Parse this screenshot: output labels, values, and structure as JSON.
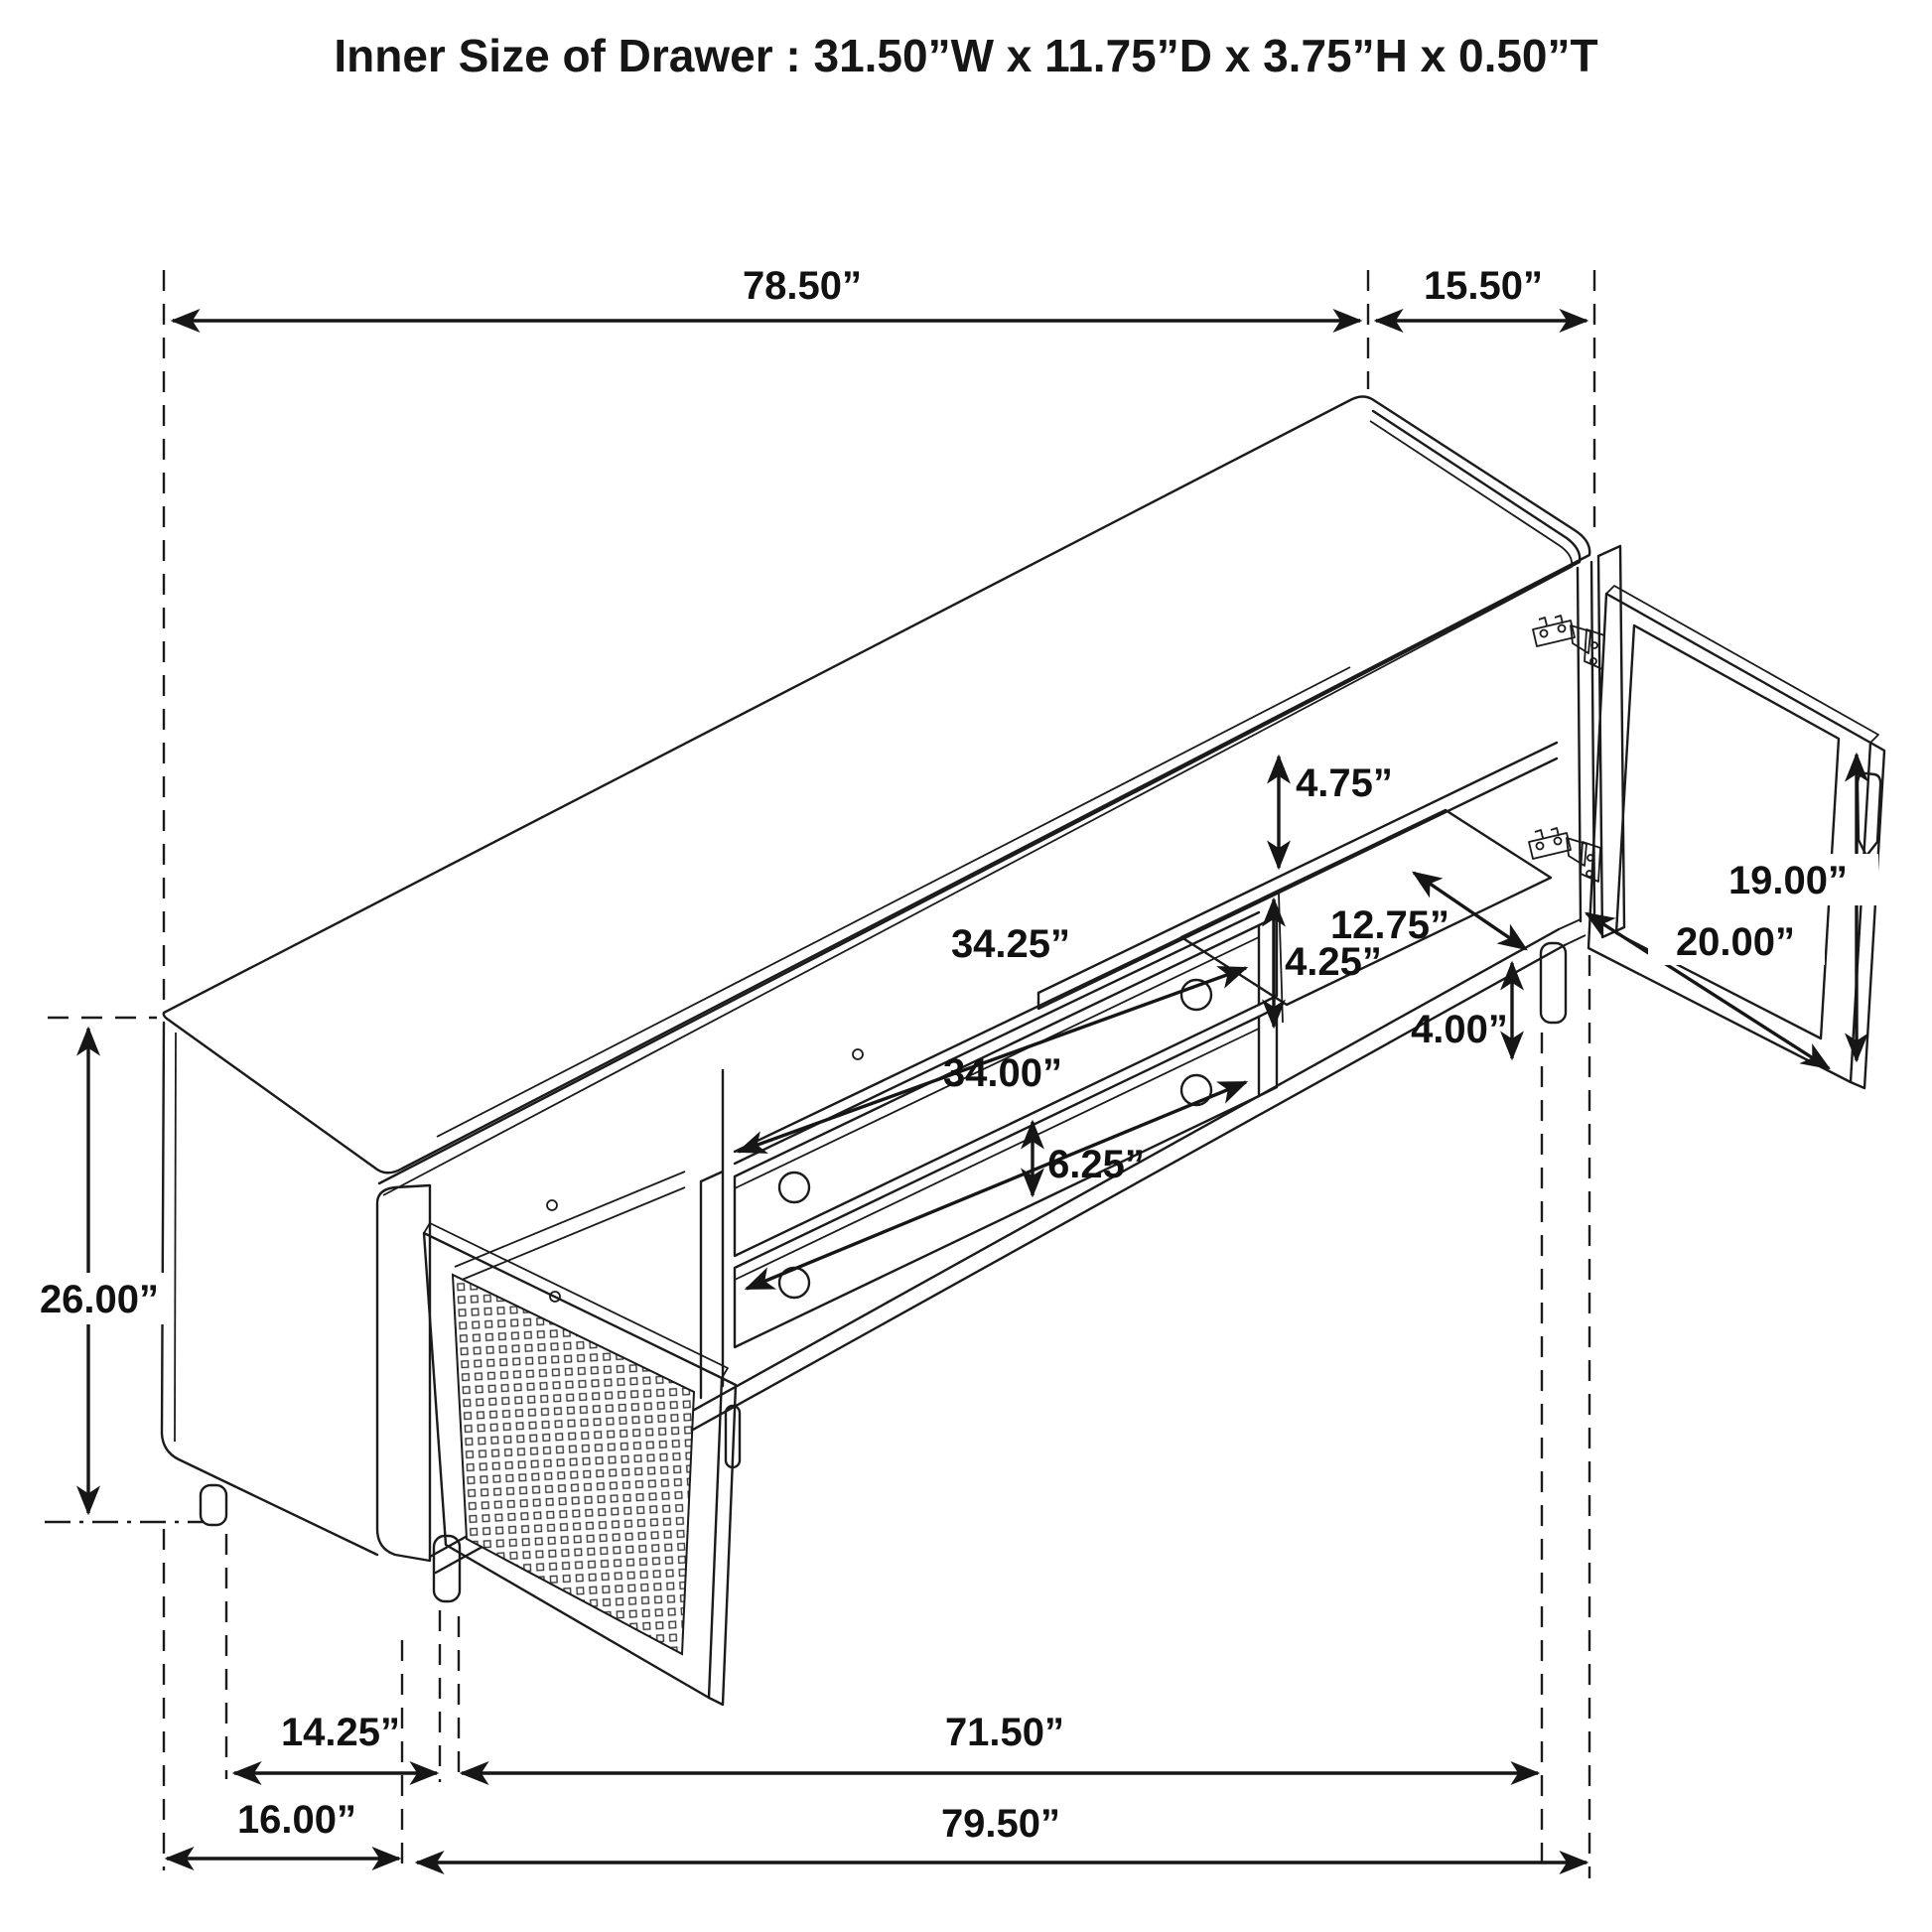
{
  "title": "Inner Size of Drawer : 31.50”W x 11.75”D x 3.75”H x 0.50”T",
  "drawer_inner_size": {
    "width_in": 31.5,
    "depth_in": 11.75,
    "height_in": 3.75,
    "thickness_in": 0.5
  },
  "units": "inches",
  "diagram_type": "furniture-dimension-line-drawing",
  "subject": "TV console sideboard, isometric view with open cane door, open right door and two drawers",
  "colors": {
    "background": "#ffffff",
    "line": "#1b1b1b",
    "label": "#111111"
  },
  "icons": [
    "dimension-arrow-icon",
    "hinge-icon",
    "knob-icon",
    "door-handle-icon",
    "cane-mesh-pattern"
  ],
  "dims": {
    "top_width": {
      "label": "78.50”",
      "value": 78.5,
      "meaning": "top panel length"
    },
    "top_depth": {
      "label": "15.50”",
      "value": 15.5,
      "meaning": "top panel depth"
    },
    "height": {
      "label": "26.00”",
      "value": 26.0,
      "meaning": "overall height"
    },
    "shelf_clearance": {
      "label": "4.75”",
      "value": 4.75,
      "meaning": "upper shelf clearance"
    },
    "shelf_depth": {
      "label": "12.75”",
      "value": 12.75,
      "meaning": "interior shelf depth"
    },
    "door_height": {
      "label": "19.00”",
      "value": 19.0,
      "meaning": "right door height"
    },
    "door_width": {
      "label": "20.00”",
      "value": 20.0,
      "meaning": "right door width"
    },
    "drawer_top_width": {
      "label": "34.25”",
      "value": 34.25,
      "meaning": "upper drawer width"
    },
    "mid_clearance": {
      "label": "4.25”",
      "value": 4.25,
      "meaning": "compartment clearance"
    },
    "leg_height": {
      "label": "4.00”",
      "value": 4.0,
      "meaning": "leg height"
    },
    "drawer_bot_width": {
      "label": "34.00”",
      "value": 34.0,
      "meaning": "lower drawer width"
    },
    "drawer_face": {
      "label": "6.25”",
      "value": 6.25,
      "meaning": "drawer face height"
    },
    "leg_inset": {
      "label": "14.25”",
      "value": 14.25,
      "meaning": "leg inset spacing"
    },
    "body_width": {
      "label": "71.50”",
      "value": 71.5,
      "meaning": "base width between legs"
    },
    "end_depth": {
      "label": "16.00”",
      "value": 16.0,
      "meaning": "end panel depth"
    },
    "total_width": {
      "label": "79.50”",
      "value": 79.5,
      "meaning": "overall width"
    }
  }
}
